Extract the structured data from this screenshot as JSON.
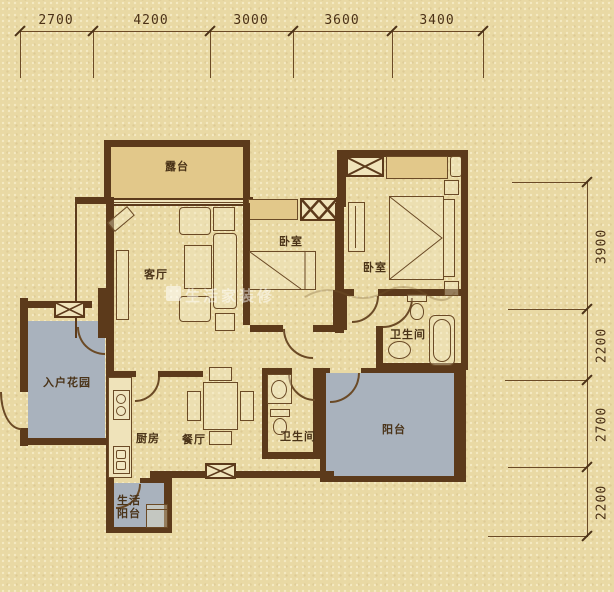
{
  "watermark": {
    "text": "生活家装修"
  },
  "rooms": {
    "terrace": "露台",
    "living_room": "客厅",
    "bedroom_1": "卧室",
    "bedroom_2": "卧室",
    "bathroom_1": "卫生间",
    "bathroom_2": "卫生间",
    "entry_garden": "入户花园",
    "kitchen": "厨房",
    "dining_room": "餐厅",
    "balcony": "阳台",
    "utility_balcony_line1": "生活",
    "utility_balcony_line2": "阳台"
  },
  "dimensions": {
    "top": [
      "2700",
      "4200",
      "3000",
      "3600",
      "3400"
    ],
    "right": [
      "3900",
      "2200",
      "2700",
      "2200"
    ]
  },
  "colors": {
    "background": "#e9d9a4",
    "wall": "#5c3a1b",
    "line": "#6b4a26",
    "bay_fill": "#e2c88a",
    "garden_fill": "#a9b2bd",
    "text": "#4b3117"
  }
}
